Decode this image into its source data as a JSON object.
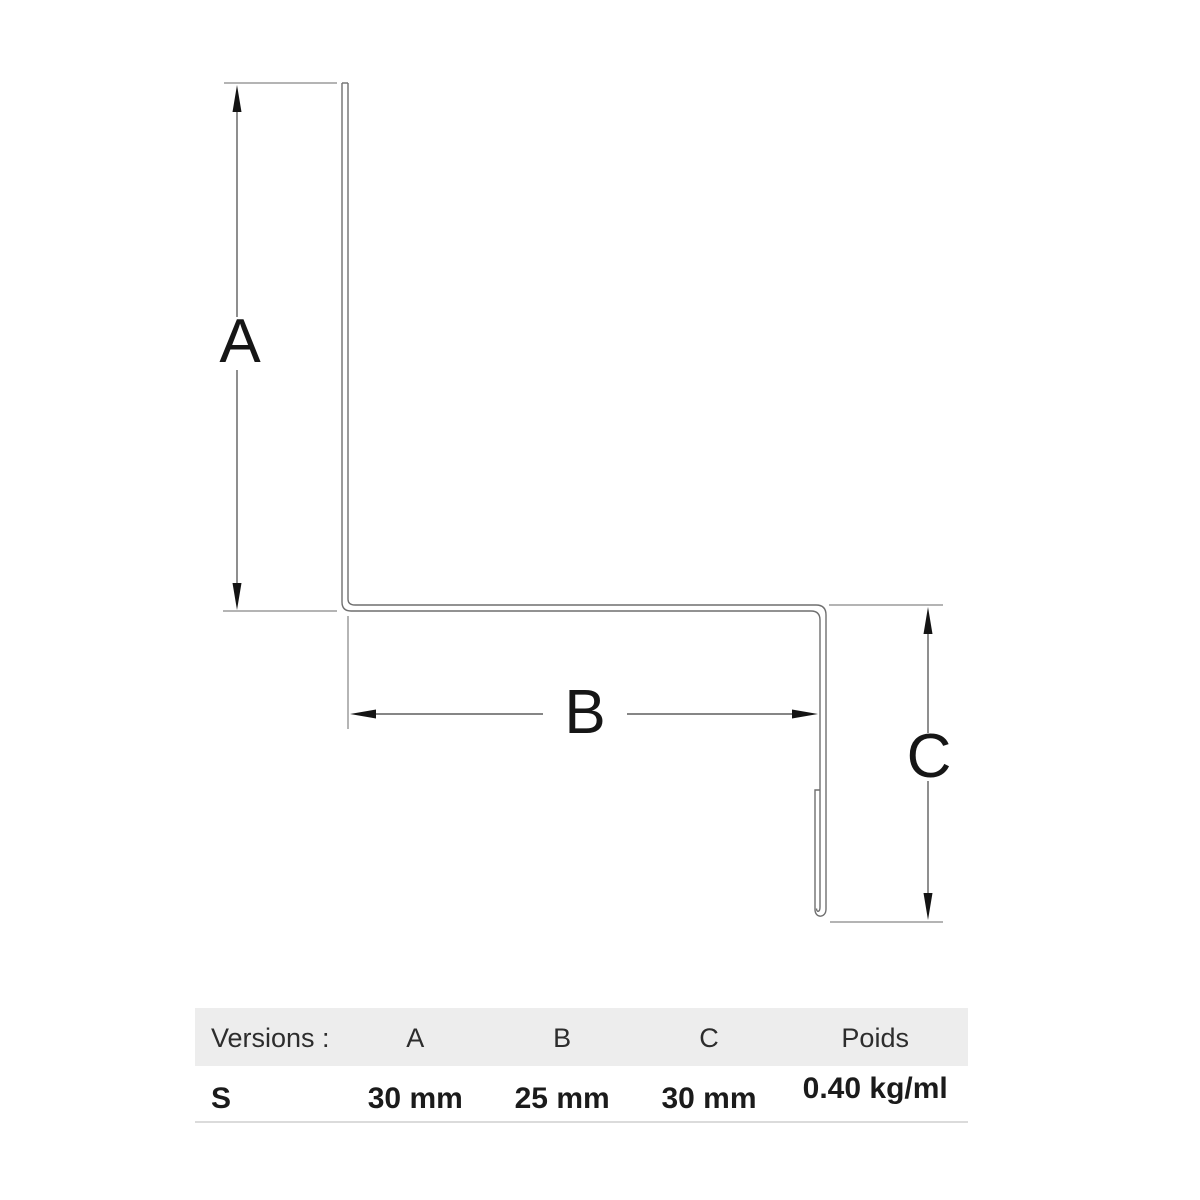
{
  "diagram": {
    "labels": {
      "a": "A",
      "b": "B",
      "c": "C"
    }
  },
  "table": {
    "headers": [
      "Versions :",
      "A",
      "B",
      "C",
      "Poids"
    ],
    "rows": [
      {
        "version": "S",
        "a": "30 mm",
        "b": "25 mm",
        "c": "30 mm",
        "poids": "0.40 kg/ml"
      }
    ]
  },
  "colors": {
    "background": "#ffffff",
    "profile_line": "#6f6f6f",
    "dimension_line": "#5f5f5f",
    "extension_line": "#9c9c9c",
    "arrowhead": "#141414",
    "label_text": "#161616",
    "table_header_bg": "#ededed",
    "table_text": "#1b1b1b",
    "table_border": "#dbdbdb"
  }
}
